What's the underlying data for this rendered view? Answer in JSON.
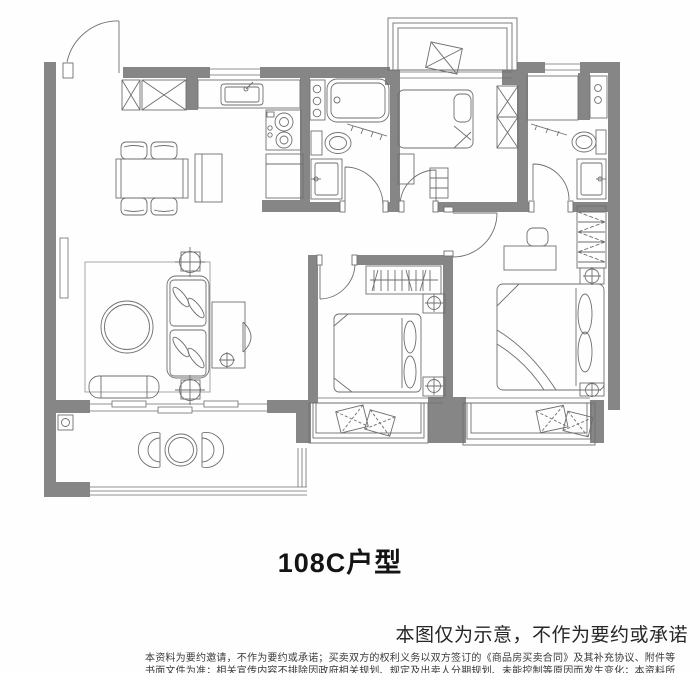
{
  "title": "108C户型",
  "notice": "本图仅为示意，不作为要约或承诺",
  "disclaimer": {
    "line1": "本资料为要约邀请，不作为要约或承诺；买卖双方的权利义务以双方签订的《商品房买卖合同》及其补充协议、附件等",
    "line2": "书面文件为准；相关宣传内容不排除因政府相关规划、规定及出卖人分期规划、未能控制等原因而发生变化；本资料所",
    "line3": "发布的内容为2022年8月20日前的信息，敬请留意最新资料。"
  },
  "floor_plan": {
    "wall_color": "#868686",
    "line_color": "#6f6f6f",
    "rooms": [
      "entry",
      "kitchen",
      "living-dining",
      "bathroom-1",
      "bedroom-2",
      "bathroom-2",
      "bedroom-3",
      "master-bedroom",
      "balcony",
      "bay-windows"
    ]
  }
}
